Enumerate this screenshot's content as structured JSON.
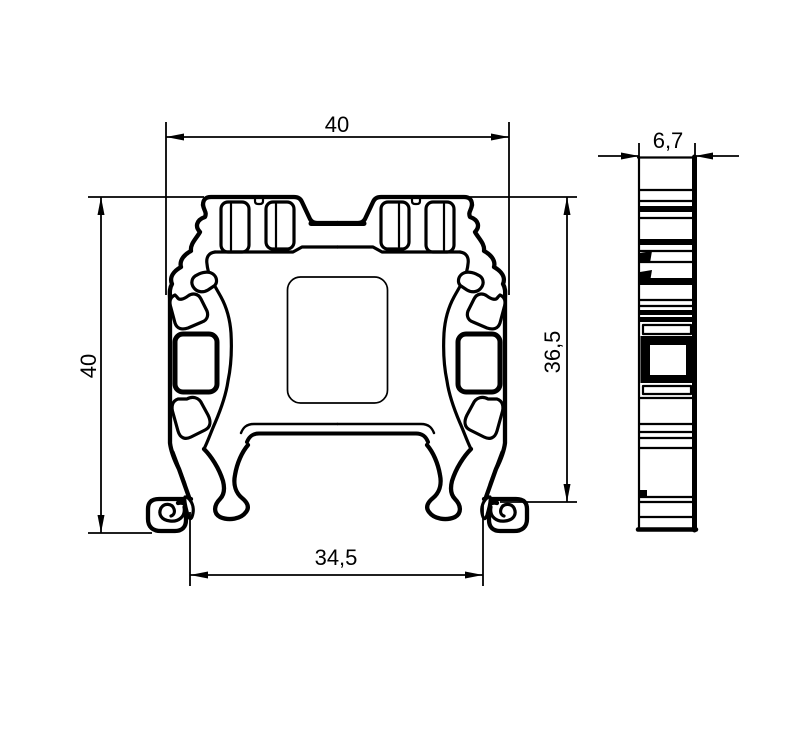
{
  "drawing": {
    "kind": "technical-2d-drawing",
    "colors": {
      "line": "#000000",
      "background": "#ffffff"
    },
    "views": {
      "front": {
        "label_count": 4
      },
      "side": {
        "label_count": 1
      }
    }
  },
  "dims": {
    "front_width_top": "40",
    "front_height_left": "40",
    "front_height_right": "36,5",
    "front_width_bottom": "34,5",
    "side_depth_top": "6,7"
  }
}
